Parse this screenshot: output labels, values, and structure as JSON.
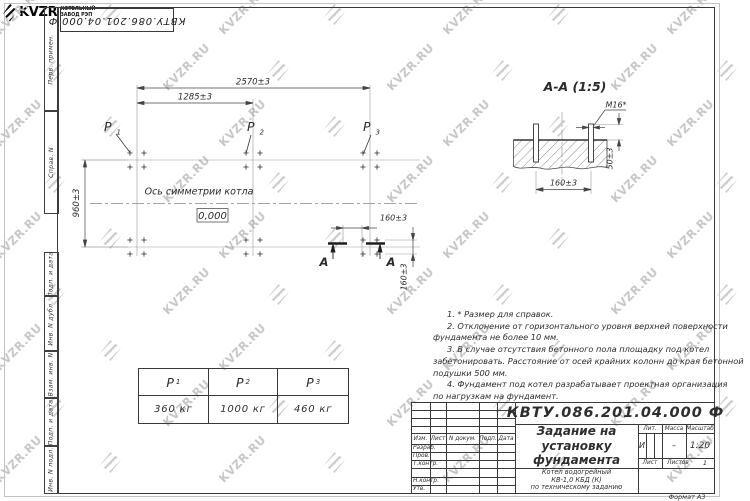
{
  "doc_number": "КВТУ.086.201.04.000  Ф",
  "watermark": {
    "text": "KVZR.RU"
  },
  "margin": {
    "labels": [
      "Перв. примен.",
      "Справ. N",
      "Подп. и дата",
      "Инв. N дубл.",
      "Взам. инв. N",
      "Подп. и дата",
      "Инв. N подл."
    ]
  },
  "plan": {
    "dim_total": "2570±3",
    "dim_half": "1285±3",
    "dim_height": "960±3",
    "dim_bolt_x": "160±3",
    "dim_bolt_y": "160±3",
    "axis_label": "Ось симметрии котла",
    "level": "0,000",
    "section_letter": "А"
  },
  "section": {
    "title": "А-А  (1:5)",
    "bolt_label": "М16*",
    "dim_protrusion": "50±3",
    "dim_spacing": "160±3"
  },
  "loads": {
    "points": [
      {
        "label": "P",
        "sub": "1",
        "value": "360  кг"
      },
      {
        "label": "P",
        "sub": "2",
        "value": "1000  кг"
      },
      {
        "label": "P",
        "sub": "3",
        "value": "460  кг"
      }
    ]
  },
  "notes": {
    "lines": [
      "1.  * Размер для справок.",
      "2.  Отклонение от горизонтального уровня верхней поверхности",
      "фундамента не более 10 мм.",
      "3.  В случае отсутствия бетонного пола площадку под котел",
      "забетонировать. Расстояние от осей крайних колонн до края бетонной",
      "подушки 500 мм.",
      "4.  Фундамент под котел разрабатывает проектная организация",
      "по нагрузкам на фундамент."
    ]
  },
  "title_block": {
    "cols": [
      "Изм.",
      "Лист",
      "N докум.",
      "Подп.",
      "Дата"
    ],
    "rows": [
      "Разраб.",
      "Пров.",
      "Т.контр.",
      "Н.контр.",
      "Утв."
    ],
    "title_lines": [
      "Задание на",
      "установку",
      "фундамента"
    ],
    "subtitle_lines": [
      "Котел водогрейный",
      "КВ-1,0  КБД  (К)",
      "по техническому заданию"
    ],
    "lit_label": "Лит.",
    "mass_label": "Масса",
    "scale_label": "Масштаб",
    "lit_value": "И",
    "mass_value": "–",
    "scale_value": "1:20",
    "sheet_label": "Лист",
    "sheets_label": "Листов",
    "sheets_value": "1",
    "logo_brand": "KVZR",
    "logo_caption": [
      "КОТЕЛЬНЫЙ",
      "ЗАВОД РЭП"
    ],
    "format": "Формат А3"
  }
}
